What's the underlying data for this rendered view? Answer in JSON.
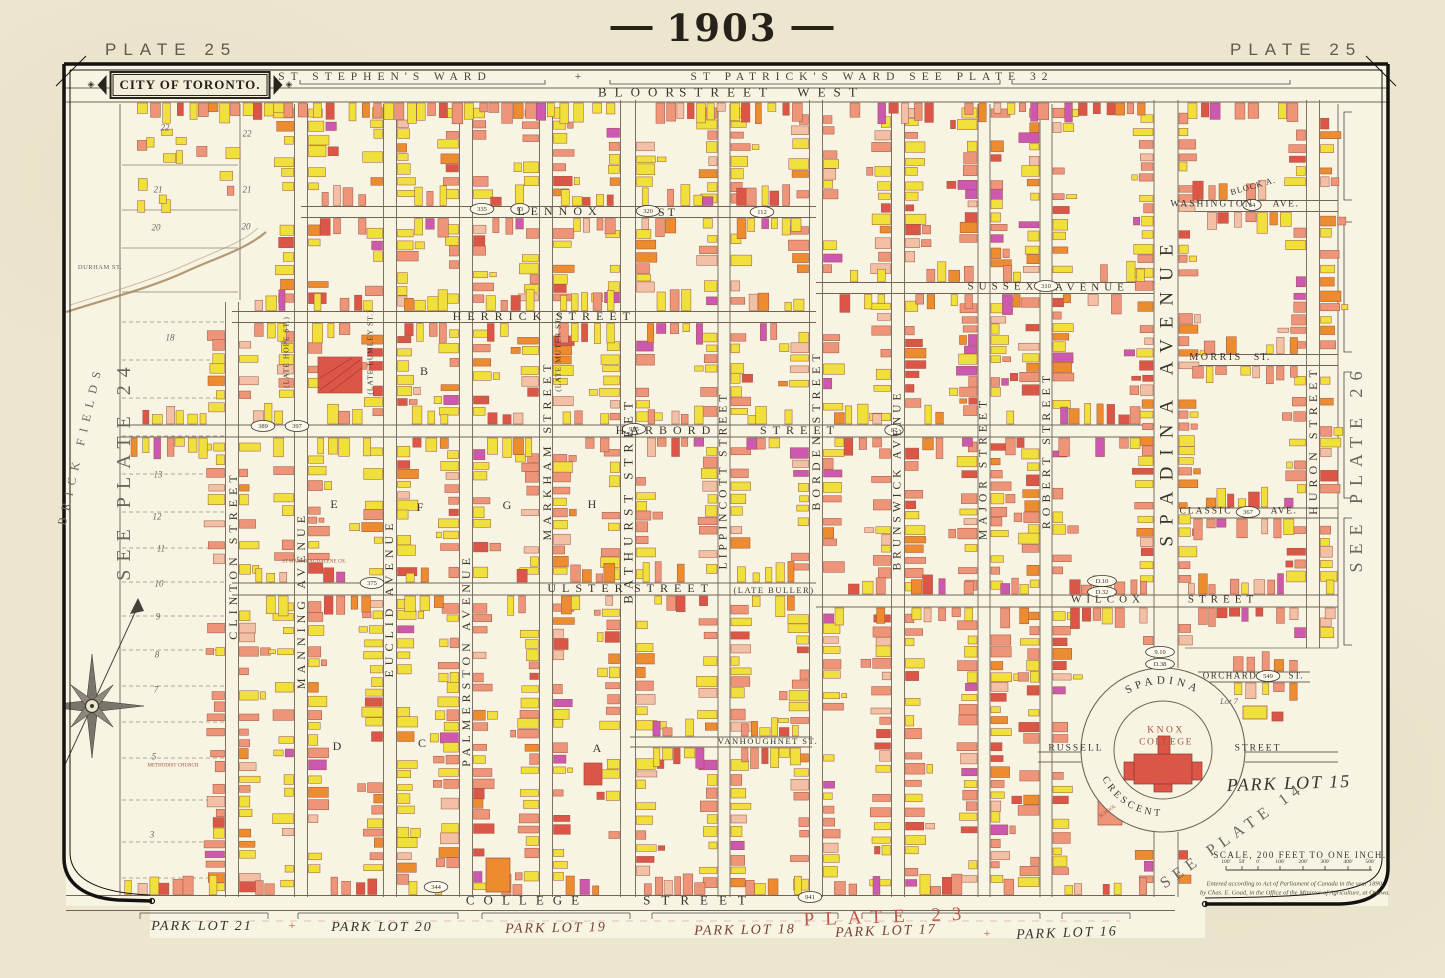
{
  "header": {
    "year": "1903",
    "plate_left": "PLATE 25",
    "plate_right": "PLATE 25"
  },
  "cartouche": {
    "title": "CITY OF TORONTO.",
    "ornament": "◈"
  },
  "wards": {
    "left": "ST STEPHEN'S WARD",
    "separator": "+",
    "right": "ST PATRICK'S WARD SEE PLATE 32"
  },
  "scale": {
    "caption": "SCALE, 200 FEET TO ONE INCH.",
    "ticks": [
      "100'",
      "50'",
      "0'",
      "100'",
      "200'",
      "300'",
      "400'",
      "500'"
    ],
    "copyright_line1": "Entered according to Act of Parliament of Canada in the year 1890,",
    "copyright_line2": "by Chas. E. Goad, in the Office of the Minister of Agriculture, at Ottawa."
  },
  "knox": {
    "line1": "KNOX",
    "line2": "COLLEGE",
    "crescent_top": "SPADINA",
    "crescent_bottom": "CRESCENT"
  },
  "colors": {
    "paper": "#ece6cf",
    "map_bg": "#f8f4e3",
    "ink": "#3a342c",
    "gray": "#6b655a",
    "red": "#c0544a",
    "red2": "#a8503c",
    "dred": "#7a4034",
    "ward": "#4a443c",
    "bld_yellow": "#f0e03c",
    "bld_salmon": "#ee9478",
    "bld_red": "#dc5648",
    "bld_orange": "#ec8c2f",
    "bld_pink": "#f2c0a4",
    "bld_magenta": "#cc58b0",
    "bld_stroke": "#9c5340",
    "line": "#6f6455",
    "frame": "#141210",
    "creek": "#a08257"
  },
  "map": {
    "v_streets": [
      {
        "n": "clinton-street",
        "x": 232,
        "y1": 302,
        "y2": 897,
        "w": 13
      },
      {
        "n": "manning-avenue",
        "x": 301,
        "y1": 104,
        "y2": 897,
        "w": 13
      },
      {
        "n": "euclid-avenue",
        "x": 390,
        "y1": 104,
        "y2": 897,
        "w": 13
      },
      {
        "n": "palmerston-avenue",
        "x": 466,
        "y1": 104,
        "y2": 897,
        "w": 13
      },
      {
        "n": "markham-street",
        "x": 546,
        "y1": 104,
        "y2": 897,
        "w": 13
      },
      {
        "n": "bathurst-street",
        "x": 628,
        "y1": 100,
        "y2": 897,
        "w": 15
      },
      {
        "n": "lippincott-street",
        "x": 724,
        "y1": 104,
        "y2": 897,
        "w": 12
      },
      {
        "n": "borden-street",
        "x": 816,
        "y1": 100,
        "y2": 897,
        "w": 13
      },
      {
        "n": "brunswick-avenue",
        "x": 898,
        "y1": 104,
        "y2": 897,
        "w": 13
      },
      {
        "n": "major-street",
        "x": 984,
        "y1": 104,
        "y2": 897,
        "w": 12
      },
      {
        "n": "robert-street",
        "x": 1046,
        "y1": 104,
        "y2": 897,
        "w": 12
      },
      {
        "n": "spadina-avenue",
        "x": 1166,
        "y1": 100,
        "y2": 668,
        "w": 24
      },
      {
        "n": "spadina-avenue-south",
        "x": 1166,
        "y1": 832,
        "y2": 897,
        "w": 24
      },
      {
        "n": "huron-street",
        "x": 1313,
        "y1": 100,
        "y2": 648,
        "w": 13
      }
    ],
    "h_streets": [
      {
        "n": "bloor-street-west",
        "y": 95,
        "x1": 66,
        "x2": 1390,
        "h": 14,
        "gt": 0,
        "gb": 1,
        "gx1": 120,
        "gx2": 1335
      },
      {
        "n": "lennox-st",
        "y": 212,
        "x1": 301,
        "x2": 816,
        "h": 11,
        "gt": 1,
        "gb": 1,
        "gx1": 307,
        "gx2": 812
      },
      {
        "n": "washington-ave",
        "y": 206,
        "x1": 1185,
        "x2": 1338,
        "h": 11,
        "gt": 1,
        "gb": 1,
        "gx1": 1190,
        "gx2": 1333
      },
      {
        "n": "herrick-street",
        "y": 317,
        "x1": 232,
        "x2": 816,
        "h": 11,
        "gt": 1,
        "gb": 1,
        "gx1": 238,
        "gx2": 812
      },
      {
        "n": "sussex-avenue",
        "y": 288,
        "x1": 816,
        "x2": 1154,
        "h": 11,
        "gt": 1,
        "gb": 1,
        "gx1": 822,
        "gx2": 1150
      },
      {
        "n": "morris-st",
        "y": 360,
        "x1": 1185,
        "x2": 1338,
        "h": 11,
        "gt": 1,
        "gb": 1,
        "gx1": 1190,
        "gx2": 1333
      },
      {
        "n": "harbord-street",
        "y": 431,
        "x1": 120,
        "x2": 1154,
        "h": 12,
        "gt": 1,
        "gb": 1,
        "gx1": 126,
        "gx2": 1150
      },
      {
        "n": "classic-ave",
        "y": 513,
        "x1": 1185,
        "x2": 1338,
        "h": 10,
        "gt": 1,
        "gb": 1,
        "gx1": 1190,
        "gx2": 1333
      },
      {
        "n": "ulster-street",
        "y": 589,
        "x1": 232,
        "x2": 816,
        "h": 12,
        "gt": 1,
        "gb": 1,
        "gx1": 238,
        "gx2": 812
      },
      {
        "n": "wilcox-street",
        "y": 601,
        "x1": 816,
        "x2": 1338,
        "h": 12,
        "gt": 1,
        "gb": 1,
        "gx1": 822,
        "gx2": 1334
      },
      {
        "n": "orchard-st",
        "y": 677,
        "x1": 1198,
        "x2": 1310,
        "h": 10,
        "gt": 1,
        "gb": 1,
        "gx1": 1202,
        "gx2": 1306
      },
      {
        "n": "vanhoughnet-st",
        "y": 742,
        "x1": 630,
        "x2": 812,
        "h": 10,
        "gt": 1,
        "gb": 1,
        "gx1": 634,
        "gx2": 808
      },
      {
        "n": "russell-st-west",
        "y": 757,
        "x1": 1038,
        "x2": 1081,
        "h": 10,
        "gt": 0,
        "gb": 0,
        "gx1": 0,
        "gx2": 0
      },
      {
        "n": "russell-st-east",
        "y": 757,
        "x1": 1245,
        "x2": 1338,
        "h": 10,
        "gt": 0,
        "gb": 0,
        "gx1": 0,
        "gx2": 0
      },
      {
        "n": "college-street",
        "y": 903,
        "x1": 66,
        "x2": 1175,
        "h": 15,
        "gt": 1,
        "gb": 0,
        "gx1": 120,
        "gx2": 1160
      }
    ],
    "crescent": {
      "cx": 1163,
      "cy": 750,
      "r_outer": 82,
      "r_inner": 49
    },
    "labels": [
      {
        "t": "BLOOR",
        "x": 640,
        "y": 92,
        "s": 13,
        "ls": 8
      },
      {
        "t": "STREET",
        "x": 727,
        "y": 92,
        "s": 13,
        "ls": 8
      },
      {
        "t": "WEST",
        "x": 831,
        "y": 92,
        "s": 13,
        "ls": 8
      },
      {
        "t": "LENNOX",
        "x": 560,
        "y": 211,
        "s": 12,
        "ls": 6
      },
      {
        "t": "ST",
        "x": 668,
        "y": 212,
        "s": 12,
        "ls": 3
      },
      {
        "t": "HERRICK",
        "x": 500,
        "y": 316,
        "s": 12,
        "ls": 6
      },
      {
        "t": "STREET",
        "x": 596,
        "y": 316,
        "s": 12,
        "ls": 6
      },
      {
        "t": "SUSSEX",
        "x": 1003,
        "y": 287,
        "s": 11,
        "ls": 5
      },
      {
        "t": "AVENUE",
        "x": 1092,
        "y": 288,
        "s": 11,
        "ls": 5
      },
      {
        "t": "WASHINGTON",
        "x": 1212,
        "y": 205,
        "s": 9.5,
        "ls": 2
      },
      {
        "t": "AVE.",
        "x": 1286,
        "y": 205,
        "s": 9.5,
        "ls": 1.5
      },
      {
        "t": "MORRIS",
        "x": 1216,
        "y": 358,
        "s": 10,
        "ls": 2.5
      },
      {
        "t": "ST.",
        "x": 1262,
        "y": 358,
        "s": 10,
        "ls": 1
      },
      {
        "t": "HARBORD",
        "x": 666,
        "y": 430,
        "s": 12,
        "ls": 6
      },
      {
        "t": "STREET",
        "x": 800,
        "y": 430,
        "s": 12,
        "ls": 6
      },
      {
        "t": "CLASSIC",
        "x": 1206,
        "y": 512,
        "s": 9.5,
        "ls": 2
      },
      {
        "t": "AVE.",
        "x": 1284,
        "y": 512,
        "s": 9.5,
        "ls": 1.5
      },
      {
        "t": "ULSTER",
        "x": 588,
        "y": 588,
        "s": 12,
        "ls": 6
      },
      {
        "t": "STREET",
        "x": 674,
        "y": 588,
        "s": 12,
        "ls": 6
      },
      {
        "t": "(LATE BULLER)",
        "x": 774,
        "y": 590,
        "s": 8.5,
        "ls": 1.5
      },
      {
        "t": "WILCOX",
        "x": 1108,
        "y": 600,
        "s": 11,
        "ls": 5
      },
      {
        "t": "STREET",
        "x": 1223,
        "y": 600,
        "s": 11,
        "ls": 5
      },
      {
        "t": "ORCHARD",
        "x": 1230,
        "y": 676,
        "s": 9,
        "ls": 1.5
      },
      {
        "t": "ST.",
        "x": 1296,
        "y": 676,
        "s": 9,
        "ls": 1
      },
      {
        "t": "VANHOUGHNET ST.",
        "x": 768,
        "y": 741,
        "s": 8.5,
        "ls": 1.5
      },
      {
        "t": "RUSSELL",
        "x": 1076,
        "y": 749,
        "s": 9.5,
        "ls": 2
      },
      {
        "t": "STREET",
        "x": 1258,
        "y": 749,
        "s": 9.5,
        "ls": 2
      },
      {
        "t": "COLLEGE",
        "x": 527,
        "y": 900,
        "s": 13,
        "ls": 9
      },
      {
        "t": "STREET",
        "x": 700,
        "y": 900,
        "s": 13,
        "ls": 11
      },
      {
        "t": "PLATE 23",
        "x": 888,
        "y": 917,
        "s": 19,
        "ls": 11,
        "c": "red",
        "r": -2
      },
      {
        "t": "DURHAM ST.",
        "x": 100,
        "y": 268,
        "s": 6.5,
        "ls": 0.5,
        "c": "gray"
      },
      {
        "t": "CLINTON STREET",
        "x": 233,
        "y": 555,
        "r": -90,
        "s": 12,
        "ls": 5
      },
      {
        "t": "MANNING AVENUE",
        "x": 301,
        "y": 600,
        "r": -90,
        "s": 12,
        "ls": 5
      },
      {
        "t": "(LATE HOPE ST.)",
        "x": 286,
        "y": 352,
        "r": -90,
        "s": 7.5,
        "ls": 1
      },
      {
        "t": "EUCLID AVENUE",
        "x": 389,
        "y": 598,
        "r": -90,
        "s": 12,
        "ls": 5
      },
      {
        "t": "(LATE LUMLEY ST.)",
        "x": 370,
        "y": 352,
        "r": -90,
        "s": 7.5,
        "ls": 1
      },
      {
        "t": "PALMERSTON AVENUE",
        "x": 466,
        "y": 660,
        "r": -90,
        "s": 12,
        "ls": 5
      },
      {
        "t": "MARKHAM STREET",
        "x": 547,
        "y": 450,
        "r": -90,
        "s": 12,
        "ls": 5
      },
      {
        "t": "(LATE MUTER ST.)",
        "x": 558,
        "y": 352,
        "r": -90,
        "s": 7.5,
        "ls": 1
      },
      {
        "t": "BATHURST STREET",
        "x": 628,
        "y": 500,
        "r": -90,
        "s": 13,
        "ls": 6
      },
      {
        "t": "LIPPINCOTT STREET",
        "x": 724,
        "y": 480,
        "r": -90,
        "s": 11.5,
        "ls": 4
      },
      {
        "t": "BORDEN STREET",
        "x": 816,
        "y": 430,
        "r": -90,
        "s": 12,
        "ls": 5
      },
      {
        "t": "BRUNSWICK AVENUE",
        "x": 898,
        "y": 480,
        "r": -90,
        "s": 11.5,
        "ls": 4
      },
      {
        "t": "MAJOR STREET",
        "x": 984,
        "y": 468,
        "r": -90,
        "s": 11.5,
        "ls": 5
      },
      {
        "t": "ROBERT STREET",
        "x": 1046,
        "y": 450,
        "r": -90,
        "s": 12,
        "ls": 5
      },
      {
        "t": "SPADINA AVENUE",
        "x": 1167,
        "y": 390,
        "r": -90,
        "s": 19,
        "ls": 11
      },
      {
        "t": "HURON STREET",
        "x": 1313,
        "y": 440,
        "r": -90,
        "s": 12,
        "ls": 5
      },
      {
        "t": "SEE PLATE 24",
        "x": 124,
        "y": 470,
        "r": -90,
        "s": 20,
        "ls": 8,
        "c": "gray"
      },
      {
        "t": "SEE PLATE 26",
        "x": 1356,
        "y": 468,
        "r": -90,
        "s": 18,
        "ls": 8,
        "c": "gray"
      },
      {
        "t": "BRICK FIELDS",
        "x": 80,
        "y": 445,
        "r": -77,
        "s": 12,
        "ls": 7,
        "c": "gray"
      },
      {
        "t": "SEE PLATE 14",
        "x": 1233,
        "y": 836,
        "r": -35,
        "s": 16,
        "ls": 6,
        "c": "gray"
      },
      {
        "t": "BLOCK A.",
        "x": 1253,
        "y": 186,
        "r": -16,
        "s": 8.5,
        "ls": 1
      },
      {
        "t": "PARK LOT 15",
        "x": 1289,
        "y": 783,
        "r": -2,
        "s": 18,
        "ls": 2,
        "i": 1
      },
      {
        "t": "PARK LOT 21",
        "x": 202,
        "y": 927,
        "s": 14,
        "ls": 2,
        "i": 1
      },
      {
        "t": "PARK LOT 20",
        "x": 382,
        "y": 928,
        "s": 14,
        "ls": 2,
        "i": 1
      },
      {
        "t": "PARK LOT 19",
        "x": 556,
        "y": 929,
        "r": -1,
        "s": 14,
        "ls": 2,
        "i": 1,
        "c": "dred"
      },
      {
        "t": "PARK LOT 18",
        "x": 745,
        "y": 931,
        "r": -1,
        "s": 14,
        "ls": 2,
        "i": 1,
        "c": "dred"
      },
      {
        "t": "PARK LOT 17",
        "x": 886,
        "y": 932,
        "r": -2,
        "s": 14,
        "ls": 2,
        "i": 1,
        "c": "dred"
      },
      {
        "t": "PARK LOT 16",
        "x": 1067,
        "y": 934,
        "r": -2,
        "s": 14,
        "ls": 2,
        "i": 1
      },
      {
        "t": "+",
        "x": 292,
        "y": 925,
        "s": 12,
        "c": "red"
      },
      {
        "t": "+",
        "x": 987,
        "y": 933,
        "s": 12,
        "c": "red"
      },
      {
        "t": "KNOX",
        "x": 1166,
        "y": 731,
        "s": 9.5,
        "ls": 2.5,
        "c": "red2"
      },
      {
        "t": "COLLEGE",
        "x": 1166,
        "y": 743,
        "s": 9.5,
        "ls": 1.5,
        "c": "red2"
      },
      {
        "t": "Lot 7",
        "x": 1229,
        "y": 701,
        "s": 8.5,
        "i": 1,
        "c": "gray"
      },
      {
        "t": "METHODIST CHURCH",
        "x": 173,
        "y": 766,
        "s": 5,
        "c": "red2"
      },
      {
        "t": "ST MARY MAGDALENE CH.",
        "x": 314,
        "y": 562,
        "s": 5,
        "c": "red2"
      },
      {
        "t": "SCHOOL",
        "x": 1108,
        "y": 812,
        "r": -35,
        "s": 5,
        "c": "red2"
      },
      {
        "t": "22",
        "x": 165,
        "y": 128,
        "s": 9,
        "i": 1,
        "c": "gray"
      },
      {
        "t": "21",
        "x": 158,
        "y": 190,
        "s": 9,
        "i": 1,
        "c": "gray"
      },
      {
        "t": "20",
        "x": 156,
        "y": 228,
        "s": 9,
        "i": 1,
        "c": "gray"
      },
      {
        "t": "22",
        "x": 247,
        "y": 134,
        "s": 9,
        "i": 1,
        "c": "gray"
      },
      {
        "t": "21",
        "x": 247,
        "y": 190,
        "s": 9,
        "i": 1,
        "c": "gray"
      },
      {
        "t": "20",
        "x": 246,
        "y": 227,
        "s": 9,
        "i": 1,
        "c": "gray"
      },
      {
        "t": "18",
        "x": 170,
        "y": 338,
        "s": 9,
        "i": 1,
        "c": "gray"
      },
      {
        "t": "13",
        "x": 158,
        "y": 475,
        "s": 9,
        "i": 1,
        "c": "gray"
      },
      {
        "t": "12",
        "x": 157,
        "y": 517,
        "s": 9,
        "i": 1,
        "c": "gray"
      },
      {
        "t": "11",
        "x": 161,
        "y": 549,
        "s": 9,
        "i": 1,
        "c": "gray"
      },
      {
        "t": "10",
        "x": 159,
        "y": 584,
        "s": 9,
        "i": 1,
        "c": "gray"
      },
      {
        "t": "9",
        "x": 158,
        "y": 617,
        "s": 9,
        "i": 1,
        "c": "gray"
      },
      {
        "t": "8",
        "x": 157,
        "y": 655,
        "s": 9,
        "i": 1,
        "c": "gray"
      },
      {
        "t": "7",
        "x": 156,
        "y": 690,
        "s": 9,
        "i": 1,
        "c": "gray"
      },
      {
        "t": "5",
        "x": 154,
        "y": 757,
        "s": 9,
        "i": 1,
        "c": "gray"
      },
      {
        "t": "3",
        "x": 152,
        "y": 835,
        "s": 9,
        "i": 1,
        "c": "gray"
      },
      {
        "t": "B",
        "x": 424,
        "y": 371,
        "s": 12
      },
      {
        "t": "E",
        "x": 334,
        "y": 504,
        "s": 12
      },
      {
        "t": "F",
        "x": 420,
        "y": 507,
        "s": 12
      },
      {
        "t": "G",
        "x": 507,
        "y": 505,
        "s": 12
      },
      {
        "t": "H",
        "x": 592,
        "y": 504,
        "s": 12
      },
      {
        "t": "D",
        "x": 337,
        "y": 746,
        "s": 12
      },
      {
        "t": "C",
        "x": 422,
        "y": 743,
        "s": 12
      },
      {
        "t": "A",
        "x": 597,
        "y": 748,
        "s": 12
      }
    ],
    "badges": [
      {
        "t": "335",
        "x": 482,
        "y": 209
      },
      {
        "t": "93",
        "x": 520,
        "y": 209
      },
      {
        "t": "320",
        "x": 648,
        "y": 211
      },
      {
        "t": "112",
        "x": 762,
        "y": 212
      },
      {
        "t": "389",
        "x": 263,
        "y": 426
      },
      {
        "t": "397",
        "x": 297,
        "y": 426
      },
      {
        "t": "935",
        "x": 634,
        "y": 429
      },
      {
        "t": "87",
        "x": 894,
        "y": 430
      },
      {
        "t": "310",
        "x": 1046,
        "y": 286
      },
      {
        "t": "375",
        "x": 372,
        "y": 583
      },
      {
        "t": "D.10",
        "x": 1102,
        "y": 581
      },
      {
        "t": "D.32",
        "x": 1102,
        "y": 592
      },
      {
        "t": "549",
        "x": 1268,
        "y": 676
      },
      {
        "t": "367",
        "x": 1248,
        "y": 512
      },
      {
        "t": "34",
        "x": 1252,
        "y": 205
      },
      {
        "t": "344",
        "x": 436,
        "y": 887
      },
      {
        "t": "941",
        "x": 810,
        "y": 897
      },
      {
        "t": "9.10",
        "x": 1160,
        "y": 652
      },
      {
        "t": "D.38",
        "x": 1160,
        "y": 664
      }
    ],
    "lot_dash_ys": [
      322,
      360,
      398,
      436,
      474,
      512,
      548,
      582,
      616,
      650,
      686,
      722,
      758,
      800,
      842,
      878
    ],
    "lot_solid_ys": [
      165,
      210,
      248,
      292
    ],
    "right_brackets": [
      [
        112,
        200
      ],
      [
        222,
        352
      ],
      [
        372,
        498
      ],
      [
        518,
        645
      ]
    ],
    "ward_brackets": [
      [
        300,
        545
      ],
      [
        610,
        1000
      ],
      [
        1012,
        1290
      ]
    ],
    "lot_brackets": [
      [
        140,
        268
      ],
      [
        298,
        458
      ],
      [
        482,
        630
      ],
      [
        652,
        838
      ],
      [
        862,
        1040
      ],
      [
        1062,
        1130
      ]
    ]
  }
}
